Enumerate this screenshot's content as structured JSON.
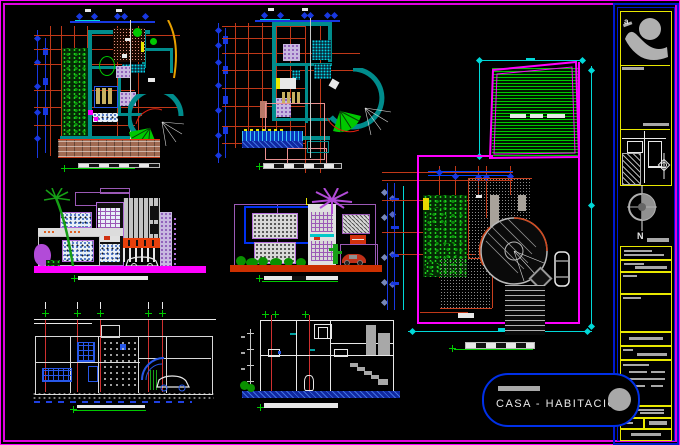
{
  "sheet": {
    "background": "#000000",
    "border_color": "#FF00FF"
  },
  "title_block": {
    "project_label": "CASA - HABITACIÒN",
    "north_label": "N",
    "logo_letter": "a"
  },
  "colors": {
    "magenta": "#FF00FF",
    "dimension_blue": "#1838E0",
    "cyan": "#00D8D8",
    "wall_teal": "#008C8C",
    "grid_orange": "#C03818",
    "green": "#00C800",
    "yellow": "#E8E800",
    "gray": "#A8A8A8",
    "white": "#E8E8E8",
    "lavender": "#B06CD8",
    "section_red": "#D03030",
    "ground_magenta": "#FF00FF",
    "ground_red": "#CC3000",
    "water_blue": "#1028A0",
    "brick": "#A06A52",
    "title_border_blue": "#0018D0",
    "capsule_border_blue": "#0030E8"
  },
  "icons": {
    "architect-logo-icon": "gray figure with circle head",
    "north-arrow-icon": "crossed circle compass with N",
    "survey-mark-icon": "crosshair ornament",
    "palm-tree-icon": "palm silhouette",
    "car-icon": "car silhouette",
    "dimension-diamond-icon": "rotated square tick",
    "level-marker-icon": "green plus tick"
  }
}
